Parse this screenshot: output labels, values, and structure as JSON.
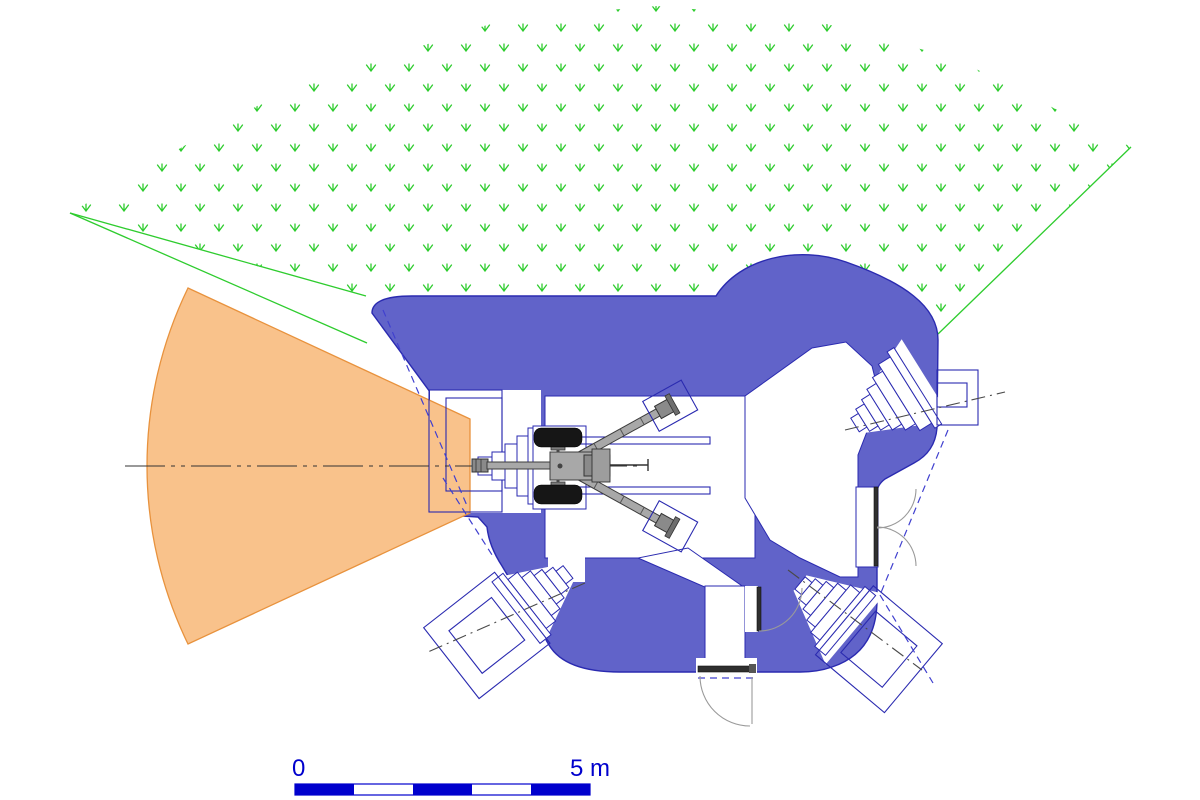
{
  "drawing": {
    "type": "fortification-casemate-floor-plan",
    "scale_bar": {
      "zero_label": "0",
      "end_label": "5 m",
      "segments": 5,
      "meters_per_segment": 1
    },
    "features": {
      "main_weapon": "anti-tank-gun-top-view",
      "fire_sector_angle_deg": 52,
      "embrasures": [
        "main-gun-embrasure-west",
        "mg-embrasure-northeast",
        "mg-embrasure-southeast",
        "mg-embrasure-southwest"
      ],
      "doors": [
        "entrance-door-south",
        "interior-door-corridor",
        "double-door-east"
      ],
      "terrain": "grass-field-of-view"
    }
  },
  "colors": {
    "wall_fill": "#6163c9",
    "wall_outline": "#2a2ab0",
    "interior_white": "#ffffff",
    "fire_sector_fill": "#f9c28b",
    "fire_sector_stroke": "#e8923d",
    "vegetation_green": "#2ecc2e",
    "scale_blue": "#0000cd",
    "dashed_blue": "#4040cf",
    "centerline_gray": "#4a4a4a",
    "door_dark": "#2f2f2f",
    "swing_arc_gray": "#9a9a9a",
    "gun_gray": "#a8a8a8",
    "gun_dark": "#3c3c3c",
    "tire_black": "#161616"
  }
}
